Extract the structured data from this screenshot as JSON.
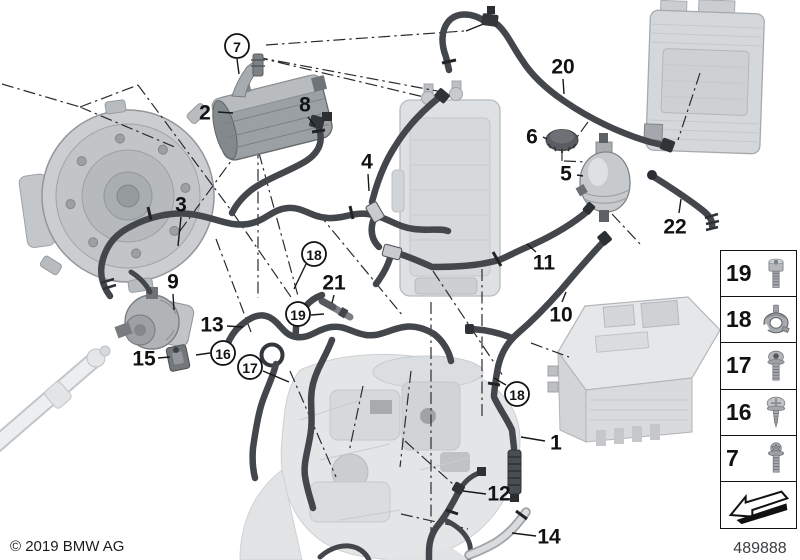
{
  "diagram": {
    "copyright": "© 2019 BMW AG",
    "part_number": "489888",
    "colors": {
      "background": "#ffffff",
      "hose": "#43474b",
      "faded_machinery": "#d9dcde",
      "callout_text": "#101214"
    },
    "callouts": [
      {
        "label": "2",
        "x": 205,
        "y": 112,
        "circled": false,
        "leader": [
          218,
          112,
          233,
          113
        ]
      },
      {
        "label": "8",
        "x": 305,
        "y": 104,
        "circled": false,
        "leader": [
          308,
          117,
          315,
          126
        ]
      },
      {
        "label": "4",
        "x": 367,
        "y": 161,
        "circled": false,
        "leader": [
          368,
          174,
          369,
          191
        ]
      },
      {
        "label": "3",
        "x": 181,
        "y": 204,
        "circled": false,
        "leader": [
          181,
          217,
          178,
          246
        ]
      },
      {
        "label": "9",
        "x": 173,
        "y": 281,
        "circled": false,
        "leader": [
          173,
          294,
          174,
          310
        ]
      },
      {
        "label": "13",
        "x": 212,
        "y": 324,
        "circled": false,
        "leader": [
          227,
          326,
          243,
          327
        ]
      },
      {
        "label": "15",
        "x": 144,
        "y": 358,
        "circled": false,
        "leader": [
          158,
          358,
          170,
          357
        ]
      },
      {
        "label": "21",
        "x": 334,
        "y": 282,
        "circled": false,
        "leader": [
          334,
          295,
          332,
          303
        ]
      },
      {
        "label": "20",
        "x": 563,
        "y": 66,
        "circled": false,
        "leader": [
          563,
          79,
          564,
          94
        ]
      },
      {
        "label": "6",
        "x": 532,
        "y": 136,
        "circled": false,
        "leader": [
          543,
          137,
          547,
          139
        ]
      },
      {
        "label": "5",
        "x": 566,
        "y": 173,
        "circled": false,
        "leader": [
          577,
          175,
          583,
          176
        ]
      },
      {
        "label": "11",
        "x": 544,
        "y": 262,
        "circled": false,
        "leader": [
          536,
          252,
          527,
          244
        ]
      },
      {
        "label": "10",
        "x": 561,
        "y": 314,
        "circled": false,
        "leader": [
          562,
          302,
          566,
          292
        ]
      },
      {
        "label": "22",
        "x": 675,
        "y": 226,
        "circled": false,
        "leader": [
          679,
          213,
          681,
          199
        ]
      },
      {
        "label": "1",
        "x": 556,
        "y": 442,
        "circled": false,
        "leader": [
          545,
          441,
          521,
          437
        ]
      },
      {
        "label": "12",
        "x": 499,
        "y": 493,
        "circled": false,
        "leader": [
          486,
          494,
          463,
          491
        ]
      },
      {
        "label": "14",
        "x": 549,
        "y": 536,
        "circled": false,
        "leader": [
          536,
          536,
          512,
          533
        ]
      },
      {
        "label": "7",
        "x": 237,
        "y": 46,
        "circled": true,
        "leader": [
          237,
          59,
          239,
          74
        ]
      },
      {
        "label": "18",
        "x": 314,
        "y": 254,
        "circled": true,
        "leader": [
          306,
          264,
          294,
          289
        ]
      },
      {
        "label": "19",
        "x": 298,
        "y": 314,
        "circled": true,
        "leader": [
          311,
          315,
          324,
          314
        ]
      },
      {
        "label": "16",
        "x": 223,
        "y": 353,
        "circled": true,
        "leader": [
          210,
          353,
          196,
          355
        ]
      },
      {
        "label": "17",
        "x": 250,
        "y": 367,
        "circled": true,
        "leader": [
          263,
          371,
          289,
          382
        ]
      },
      {
        "label": "18",
        "x": 517,
        "y": 394,
        "circled": true,
        "leader": [
          506,
          385,
          494,
          378
        ]
      }
    ],
    "legend": {
      "items": [
        {
          "label": "19",
          "icon": "cap-screw"
        },
        {
          "label": "18",
          "icon": "clamp"
        },
        {
          "label": "17",
          "icon": "dome-screw"
        },
        {
          "label": "16",
          "icon": "pan-screw"
        },
        {
          "label": "7",
          "icon": "torx-screw"
        }
      ],
      "arrow": {
        "icon": "arrow"
      }
    }
  }
}
